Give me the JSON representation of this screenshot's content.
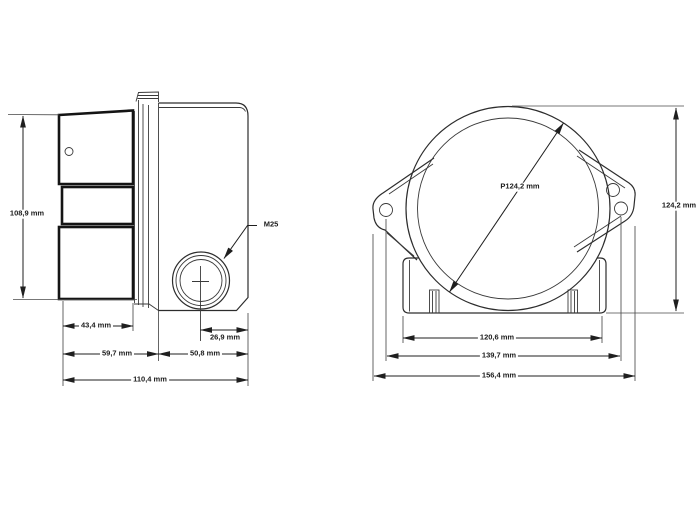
{
  "page": {
    "kind": "technical-dimension-drawing",
    "units": "mm"
  },
  "side_view": {
    "height": "108,9 mm",
    "horn_depth": "43,4 mm",
    "gland_offset": "26,9 mm",
    "horn_section_depth": "59,7 mm",
    "body_depth": "50,8 mm",
    "overall_depth": "110,4 mm",
    "cable_gland": "M25"
  },
  "front_view": {
    "flange_diameter": "P124,2 mm",
    "overall_height": "124,2 mm",
    "base_width": "120,6 mm",
    "mounting_hole_span": "139,7 mm",
    "overall_width": "156,4 mm"
  },
  "colors": {
    "line": "#2d2d2d",
    "thick_line": "#141414",
    "dimension_line": "#1f1f1f",
    "text": "#1a1a1a",
    "background": "#ffffff"
  }
}
